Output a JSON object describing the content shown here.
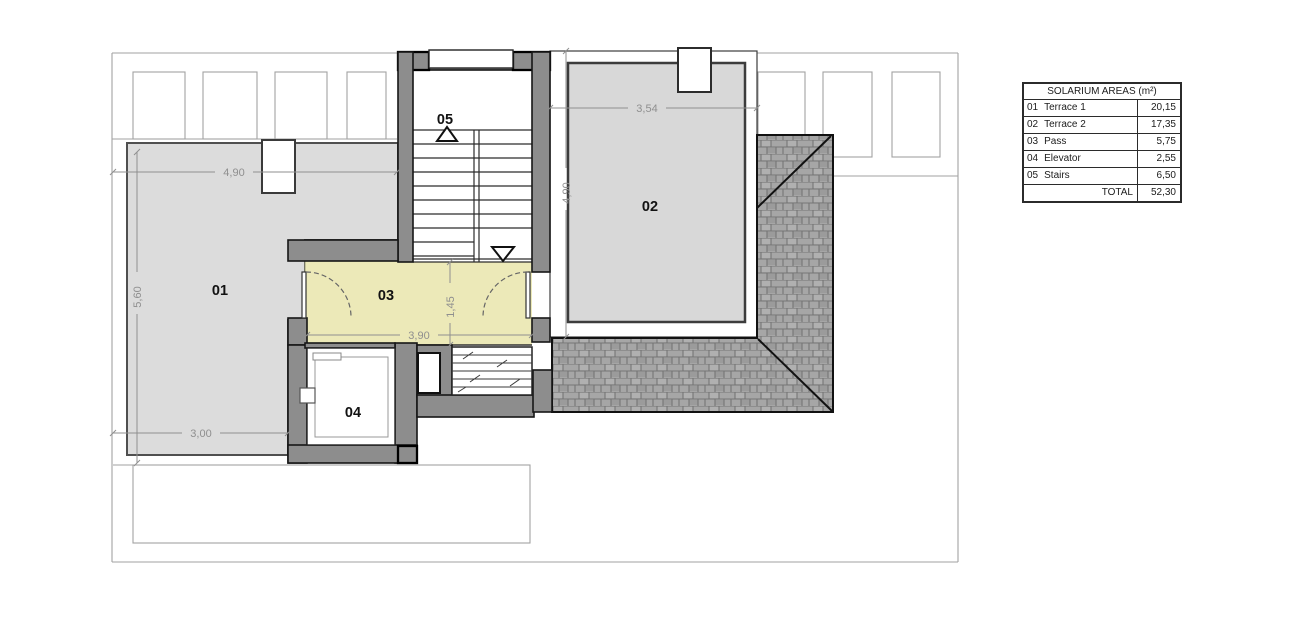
{
  "plan": {
    "room_labels": [
      "01",
      "02",
      "03",
      "04",
      "05"
    ],
    "dims": {
      "terrace1_width": "4,90",
      "terrace1_depth": "5,60",
      "terrace1_bottom_width": "3,00",
      "pass_width": "3,90",
      "pass_depth": "1,45",
      "terrace2_width": "3,54",
      "terrace2_depth": "4,90"
    }
  },
  "table": {
    "title": "SOLARIUM  AREAS (m²)",
    "rows": [
      {
        "num": "01",
        "label": "Terrace 1",
        "value": "20,15"
      },
      {
        "num": "02",
        "label": "Terrace 2",
        "value": "17,35"
      },
      {
        "num": "03",
        "label": "Pass",
        "value": "5,75"
      },
      {
        "num": "04",
        "label": "Elevator",
        "value": "2,55"
      },
      {
        "num": "05",
        "label": "Stairs",
        "value": "6,50"
      }
    ],
    "total_label": "TOTAL",
    "total_value": "52,30"
  },
  "colors": {
    "pass_fill": "#ece9b8",
    "terrace_fill": "#dcdcdc",
    "wall_fill": "#8d8d8d",
    "roof_fill": "#a6a6a6"
  }
}
